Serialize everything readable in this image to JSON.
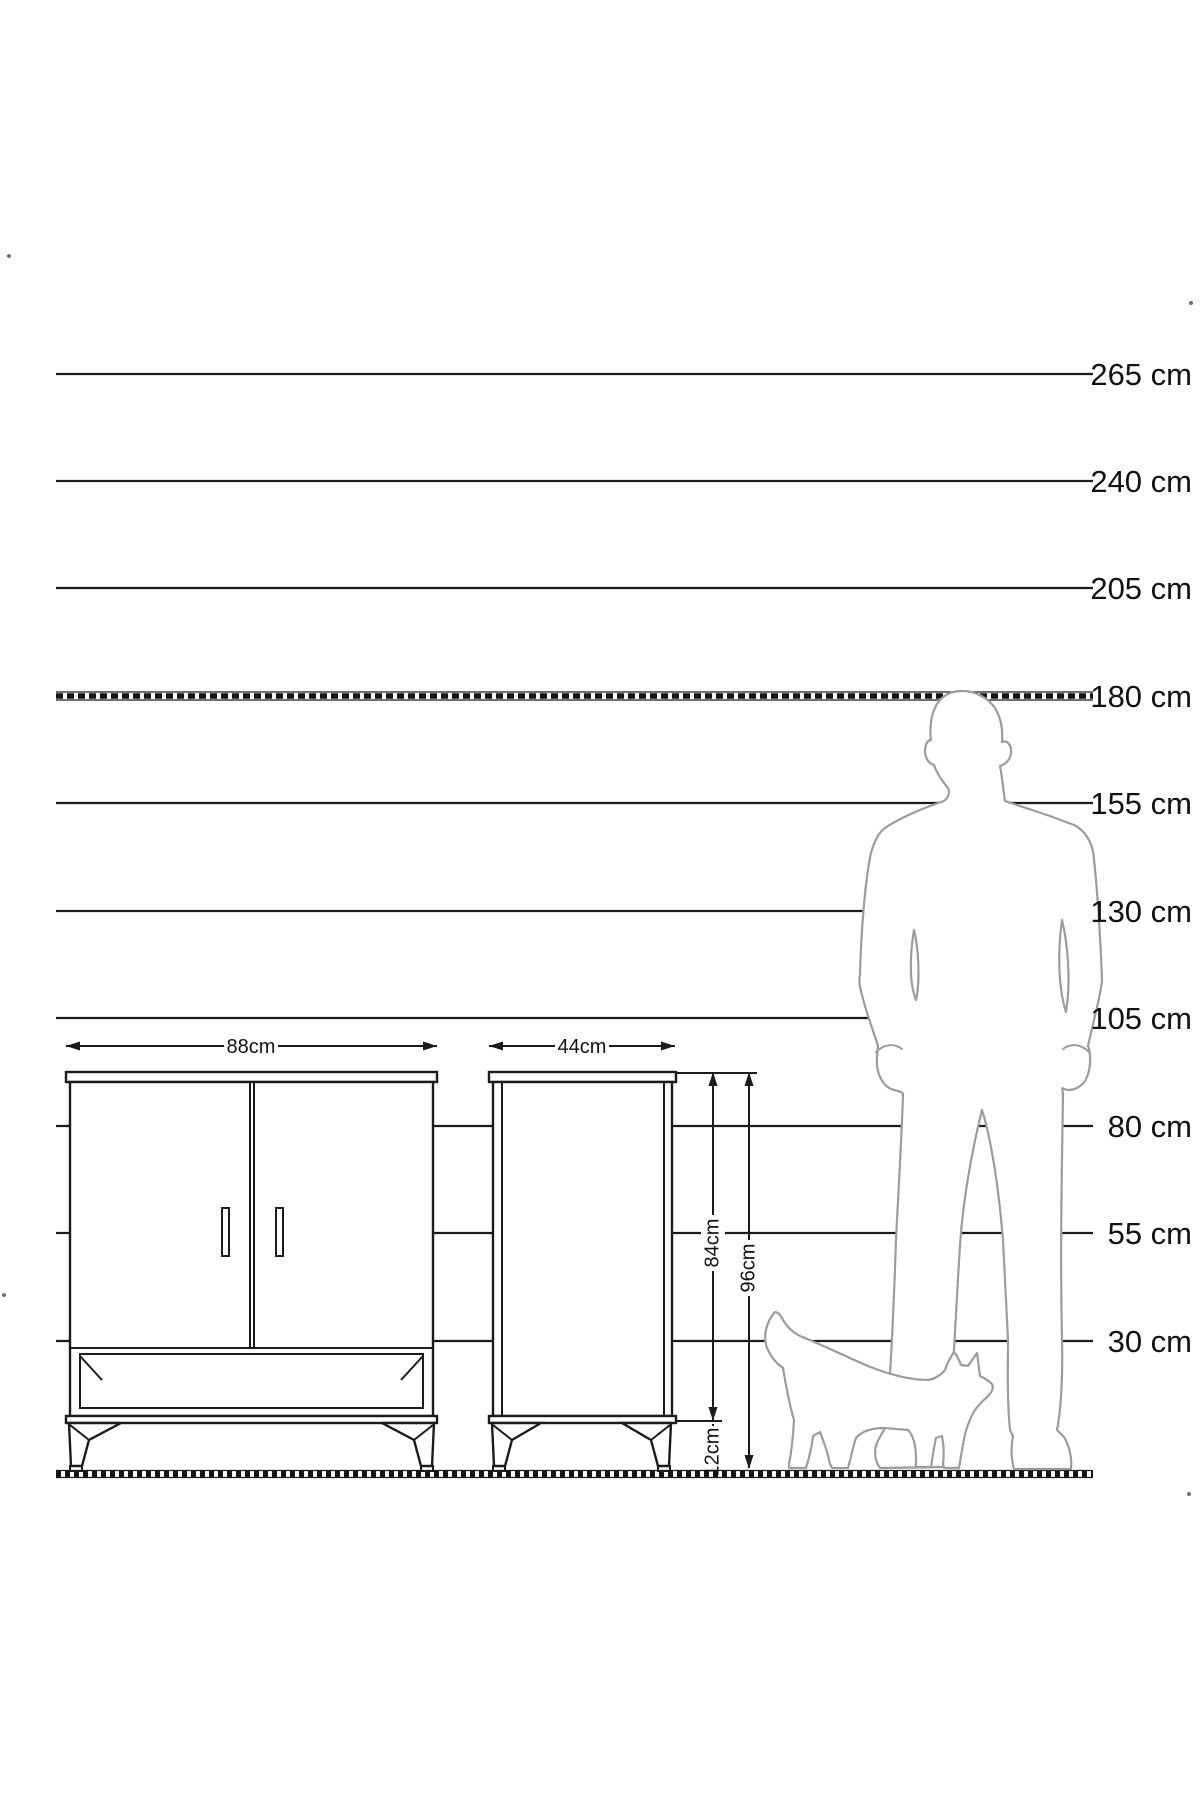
{
  "palette": {
    "background": "#ffffff",
    "scale_line": "#1b1b1b",
    "figure_outline": "#9c9c9c",
    "text": "#121212"
  },
  "height_scale": {
    "unit": "cm",
    "labels": [
      "265 cm",
      "240 cm",
      "205 cm",
      "180 cm",
      "155 cm",
      "130 cm",
      "105 cm",
      "80 cm",
      "55 cm",
      "30 cm"
    ],
    "hatched_reference_label": "180 cm"
  },
  "furniture": {
    "front_width_label": "88cm",
    "side_depth_label": "44cm",
    "body_height_label": "84cm",
    "total_height_label": "96cm",
    "leg_height_label": "12cm"
  },
  "figures": {
    "human": "man-silhouette",
    "animal": "cat-silhouette"
  }
}
